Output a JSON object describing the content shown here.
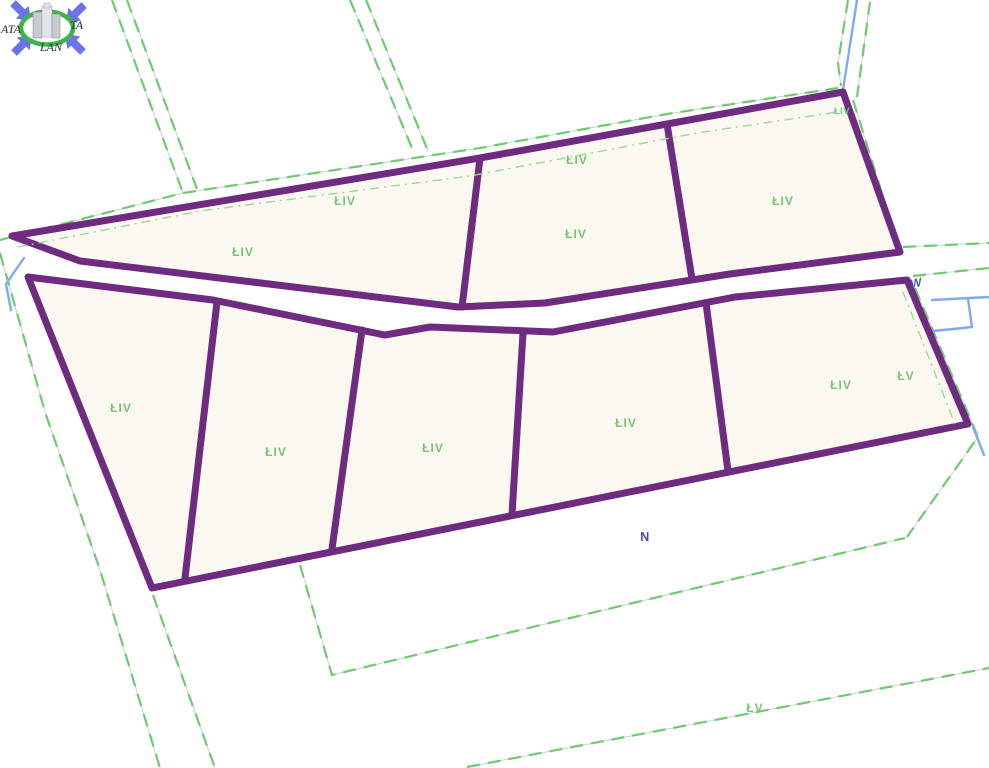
{
  "app": {
    "title": "cadastral parcel map view"
  },
  "logo": {
    "text_left": "ATA",
    "text_right": "TA",
    "text_bottom": "LAN"
  },
  "colors": {
    "boundary-purple": "#6e2b80",
    "parcel-fill": "#faf8f0",
    "dash-green": "#6dcb6d",
    "dashdot-green": "#9ad99a",
    "label-green": "#74c674",
    "water-blue": "#7fa9f2",
    "annot-blue": "#4a4fb5",
    "bg": "#ffffff"
  },
  "map": {
    "land_class_labels": [
      {
        "id": "top-wedge-upper",
        "text": "ŁIV"
      },
      {
        "id": "top-wedge-main",
        "text": "ŁIV"
      },
      {
        "id": "top-middle-upper",
        "text": "ŁIV"
      },
      {
        "id": "top-middle-main",
        "text": "ŁIV"
      },
      {
        "id": "top-right-main",
        "text": "ŁIV"
      },
      {
        "id": "top-right-corner",
        "text": "ŁIV"
      },
      {
        "id": "bottom-parcel-1",
        "text": "ŁIV"
      },
      {
        "id": "bottom-parcel-2",
        "text": "ŁIV"
      },
      {
        "id": "bottom-parcel-3",
        "text": "ŁIV"
      },
      {
        "id": "bottom-parcel-4",
        "text": "ŁIV"
      },
      {
        "id": "bottom-parcel-5",
        "text": "ŁIV"
      },
      {
        "id": "right-outside",
        "text": "ŁV"
      },
      {
        "id": "bottom-outside",
        "text": "ŁV"
      }
    ],
    "annotations": [
      {
        "id": "water-ditch",
        "text": "W"
      },
      {
        "id": "strip-below",
        "text": "N"
      }
    ]
  }
}
